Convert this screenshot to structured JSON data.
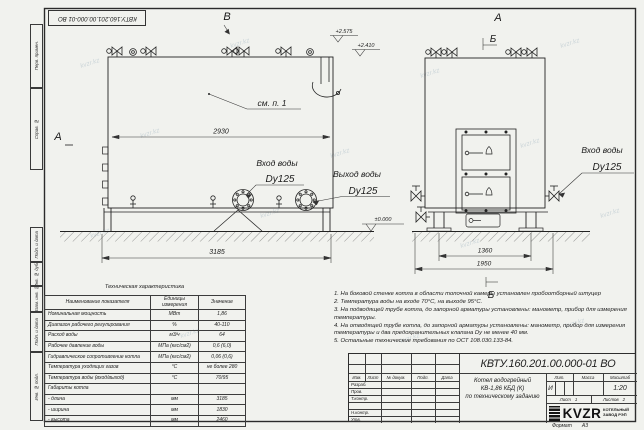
{
  "page": {
    "watermark": "kvzr.kz",
    "format_label": "Формат",
    "format_value": "А3"
  },
  "margins": {
    "labels": [
      "Перв. примен.",
      "Справ. №",
      "Подп. и дата",
      "Инв. № дубл.",
      "Взам. инв. №",
      "Подп. и дата",
      "Инв. № подл."
    ]
  },
  "corner_stamp": "КВТУ.160.201.00.000-01 ВО",
  "drawing": {
    "view_a": "А",
    "view_b": "Б",
    "view_v": "В",
    "callout": "см. п. 1",
    "dim_front_top": "2930",
    "dim_front_bottom": "3185",
    "dim_side_inner": "1360",
    "dim_side_outer": "1950",
    "elev_valves": "+2.575",
    "elev_top": "+2.410",
    "elev_zero": "±0.000",
    "inlet_label": "Вход воды",
    "inlet_dn": "Dy125",
    "outlet_label": "Выход воды",
    "outlet_dn": "Dy125",
    "inlet2_label": "Вход воды",
    "inlet2_dn": "Dy125"
  },
  "spec_table": {
    "title": "Техническая характеристика",
    "headers": [
      "Наименование показателя",
      "Единицы измерения",
      "Значение"
    ],
    "rows": [
      [
        "Номинальная мощность",
        "МВт",
        "1,86"
      ],
      [
        "Диапазон рабочего регулирования",
        "%",
        "40-110"
      ],
      [
        "Расход воды",
        "м3/ч",
        "64"
      ],
      [
        "Рабочее давление воды",
        "МПа (кгс/см2)",
        "0,6 (6,0)"
      ],
      [
        "Гидравлическое сопротивление котла",
        "МПа (кгс/см2)",
        "0,06 (0,6)"
      ],
      [
        "Температура уходящих газов",
        "°С",
        "не более 280"
      ],
      [
        "Температура воды (вход/выход)",
        "°С",
        "70/95"
      ],
      [
        "Габариты котла",
        "",
        ""
      ],
      [
        "- длина",
        "мм",
        "3185"
      ],
      [
        "- ширина",
        "мм",
        "1830"
      ],
      [
        "- высота",
        "мм",
        "2460"
      ]
    ]
  },
  "notes": [
    "1.  На боковой стенке котла в области топочной камеры установлен пробоотборный штуцер",
    "2.  Температура воды на входе 70°С, на выходе 95°С.",
    "3.  На подводящей трубе котла, до запорной арматуры установлены: манометр, прибор для измерения температуры.",
    "4.  На отводящей трубе котла, до запорной арматуры установлены: манометр, прибор для измерения температуры и два предохранительных клапана Dу не менее 40 мм.",
    "5.  Остальные технические требования по ОСТ 108.030.133-84."
  ],
  "title_block": {
    "doc_number": "КВТУ.160.201.00.000-01 ВО",
    "col_headers": [
      "Изм.",
      "Лист",
      "№ докум.",
      "Подп.",
      "Дата"
    ],
    "sig_rows": [
      "Разраб.",
      "Пров.",
      "Т.контр.",
      "Н.контр.",
      "Утв."
    ],
    "title_line1": "Котел водогрейный",
    "title_line2": "КВ-1,86 КБД (К)",
    "title_line3": "по техническому заданию",
    "lit_label": "Лит.",
    "lit_value": "И",
    "mass_label": "Масса",
    "scale_label": "Масштаб",
    "scale_value": "1:20",
    "sheet_label": "Лист",
    "sheet_value": "1",
    "sheets_label": "Листов",
    "sheets_value": "2",
    "logo_text": "KVZR",
    "logo_sub": "КОТЕЛЬНЫЙ ЗАВОД РЭП"
  }
}
